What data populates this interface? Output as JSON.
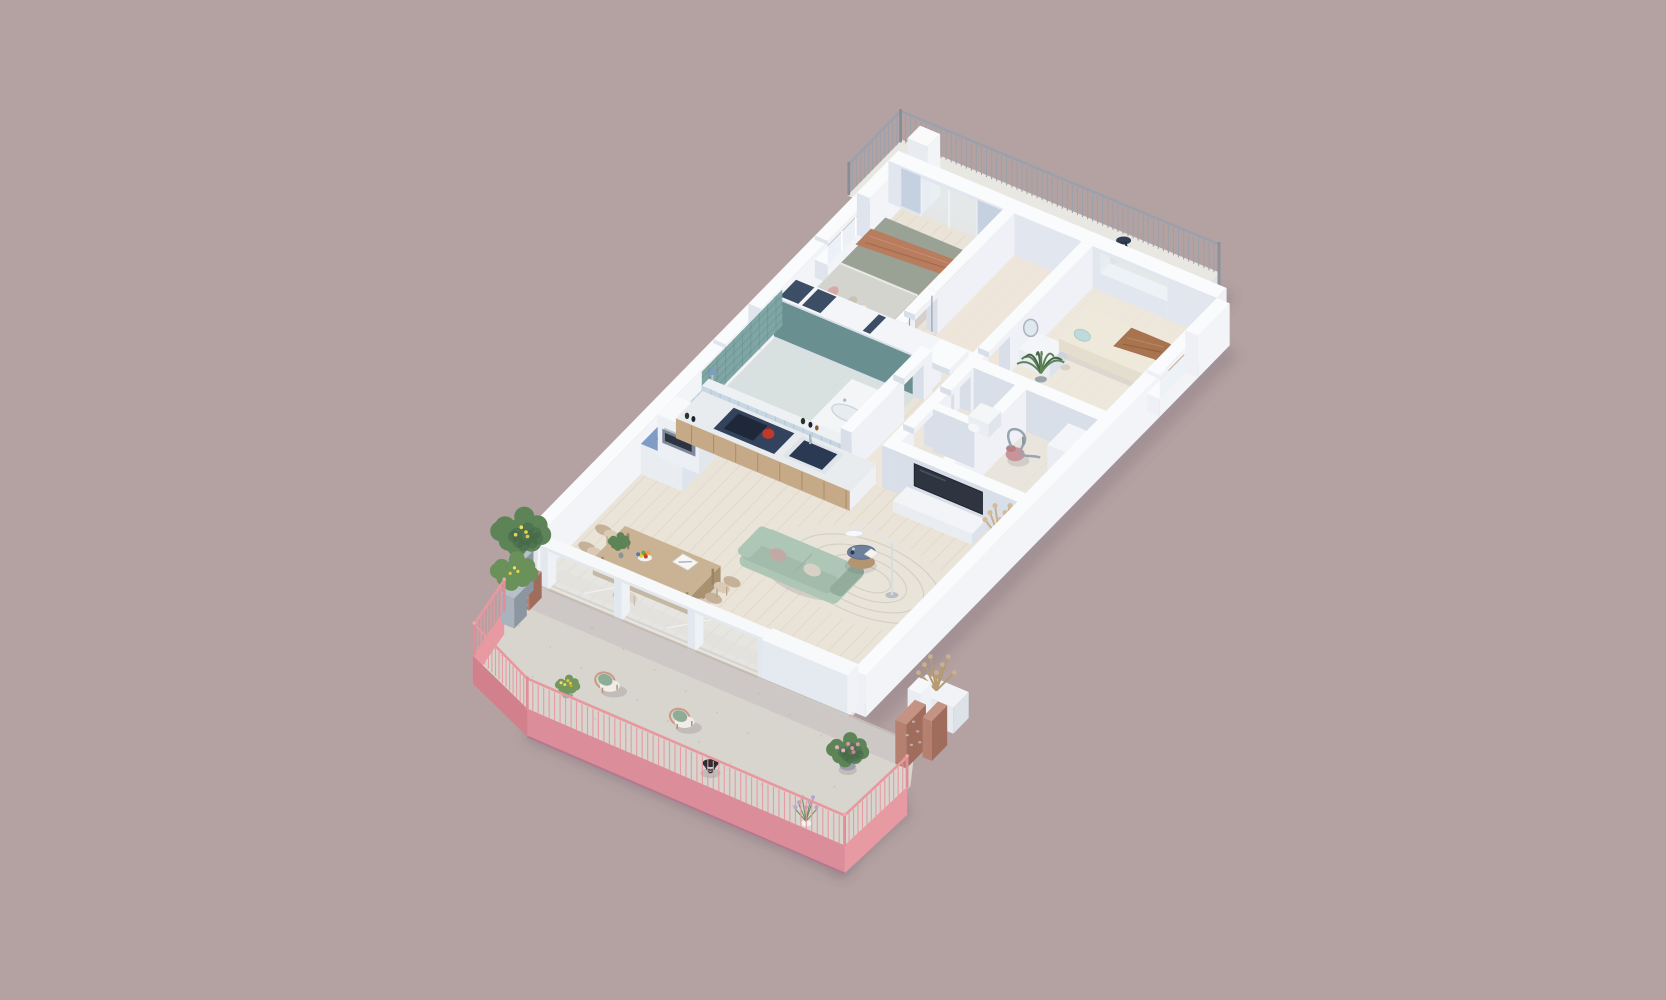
{
  "palette": {
    "bg": "#b4a2a2",
    "shadow": "rgba(88,76,96,0.28)",
    "wall_top": "#fafbfc",
    "wall_sw": "#d9dfe9",
    "wall_se": "#eff1f6",
    "wall_inner": "#f2f4f7",
    "teal": "#7fa5a5",
    "teal_dark": "#5f8889",
    "tile_blue": "#c7d6e3",
    "floor_wood": "#eae3d7",
    "floor_wood_line": "#d9cfc0",
    "floor_bath": "#d6dfe1",
    "floor_hall": "#eee5da",
    "floor_terrace": "#d8d4ce",
    "floor_balcony": "#e9e7e2",
    "glass": "#dfe9f0",
    "accent_blue": "#bfcdde",
    "bed_frame": "#c7a87e",
    "bed_head": "#eae6dc",
    "bed_gray": "#d3d4ce",
    "bed_green": "#99a295",
    "throw": "#b87c5e",
    "pink_pillow": "#d8a8a8",
    "wardrobe_dark": "#3c4e66",
    "sofa": "#aec6b6",
    "sofa_dark": "#93ad9d",
    "cushion": "#d8d1c6",
    "cushion_pink": "#c2a9a4",
    "rug": "#e8e4da",
    "rug_line": "#d6d0c2",
    "ctable_top": "#6e809c",
    "ctable_wood": "#b39572",
    "dtable": "#cab394",
    "dtable_side": "#b59d7c",
    "chair": "#dacaB4",
    "chair_dark": "#c3ae94",
    "kitchen_wood": "#c6aa88",
    "kitchen_wood_dark": "#b2946f",
    "counter_navy": "#33435e",
    "cooktop": "#1e2838",
    "sink_basin": "#2b3a52",
    "chrome": "#aab8c4",
    "kettle_red": "#c0392b",
    "unit_blue": "#7e9cc6",
    "oven_face": "#7c8798",
    "oven_glass": "#2c3442",
    "tv": "#2e3440",
    "daybed": "#efe9dc",
    "daybed_blanket": "#a8734f",
    "pillow_blue": "#bedadb",
    "vacuum_pink": "#c9939a",
    "plant_green": "#5d8457",
    "plant_dark": "#46694a",
    "lemon_yellow": "#e8d44d",
    "flower_yellow": "#e5c93d",
    "flower_pink": "#d795a9",
    "lavender": "#b7a5cf",
    "pot_gray": "#9aa4ae",
    "pot_white": "#f1f1ef",
    "planter_gray": "#a9b3bd",
    "brick": "#b5806f",
    "brick_dark": "#a06d5d",
    "rail_pink": "#e8989f",
    "fascia_pink": "#db8e99",
    "fascia_dark": "#d2808c",
    "fascia_light": "#e89aa2",
    "rail_gray": "#9aa1ab",
    "wicker": "#c9a98c",
    "cushion_sage": "#8fac97",
    "cushion_white": "#efede6",
    "table_navy": "#2f3e53",
    "lamp_white": "#f7f8f9",
    "metal": "#9aa3ac",
    "pampas": "#c9b08e"
  },
  "elements": {
    "scene-shadow": "drop-shadow",
    "balcony": "balcony-floor",
    "balcony-railing": "balcony-metal-railing",
    "chimney-wall": "balcony-divider-wall",
    "balcony-lounge-chair": "balcony-lounge-chair",
    "balcony-bistro-table": "balcony-bistro-table",
    "floor-slab": "apartment-floor",
    "nw-wall": "north-west-wall",
    "ne-wall": "north-east-wall",
    "master-bedroom": "master-bedroom",
    "bedroom-partition": "bedroom-partition-wall",
    "partition-a330": "bedroom-bathroom-wall-with-wardrobe",
    "bathroom": "bathroom",
    "half-wall-tiled": "kitchen-tiled-half-wall",
    "bath-corridor-wall": "bathroom-corridor-wall",
    "corridor-wall": "corridor-wall",
    "second-bedroom": "second-bedroom",
    "inner-partitions": "utility-partitions",
    "wc-room": "wc-room",
    "storage-room": "storage-room",
    "tv-wall": "tv-wall",
    "kitchen": "kitchen",
    "dining-area": "dining-area",
    "living-room": "living-room",
    "se-wall": "south-east-wall",
    "pampas-planter": "corner-planter",
    "glass-wall": "terrace-glass-wall",
    "terrace": "terrace-floor",
    "terrace-fascia": "terrace-fascia",
    "terrace-planters": "terrace-planters",
    "outdoor-chairs": "terrace-wicker-chairs",
    "wire-table": "terrace-wire-table",
    "flower-pot-pink": "pink-flower-pot",
    "lavender-pot": "lavender-pot",
    "brick-walls": "terrace-brick-walls",
    "terrace-railing": "terrace-pink-railing"
  }
}
